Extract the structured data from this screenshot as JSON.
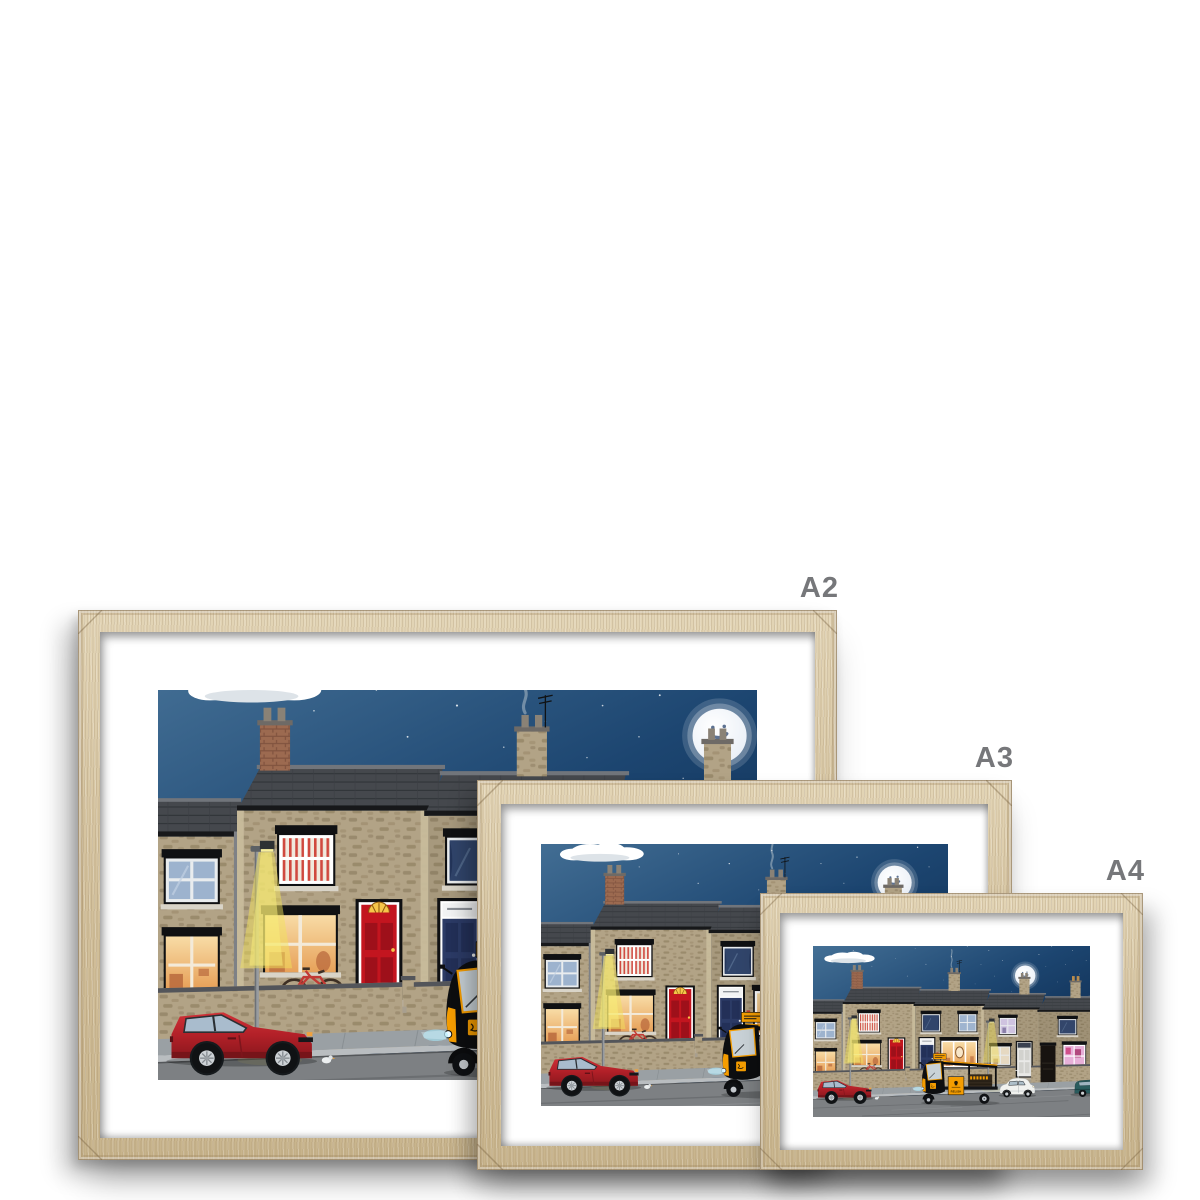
{
  "page": {
    "background": "#ffffff"
  },
  "mockup": {
    "frames": [
      {
        "label": "A2"
      },
      {
        "label": "A3"
      },
      {
        "label": "A4"
      }
    ]
  },
  "artwork": {
    "trike_sign_text": "RELISH"
  },
  "colors": {
    "page": "#ffffff",
    "label_text": "#76777a",
    "wood_light": "#e3d5b6",
    "wood_mid": "#d4c29e",
    "wood_dark": "#c8b48c",
    "mat": "#ffffff",
    "sky_top": "#49759a",
    "sky_mid": "#1c4570",
    "sky_deep": "#0a2547",
    "stone": "#b2a386",
    "stone_dark": "#8f7f62",
    "roof": "#45484d",
    "door_red": "#c3151f",
    "door_navy": "#2c3b66",
    "lamp_glow": "#f1e15b",
    "window_warm_light": "#f8dca6",
    "window_warm_deep": "#e7a159",
    "car_red": "#b22028",
    "trike_orange": "#f59d00",
    "moon": "#fdfdfb",
    "road": "#7d8083",
    "pavement": "#9aa0a4"
  }
}
